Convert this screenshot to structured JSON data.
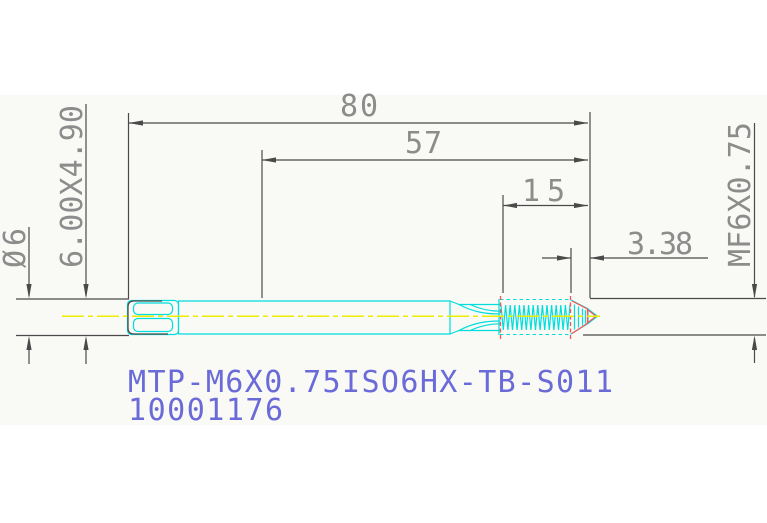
{
  "window": {
    "title": "CAD tap drawing"
  },
  "dimensions": {
    "overall_length": {
      "label": "80"
    },
    "functional_length": {
      "label": "57"
    },
    "thread_length": {
      "label": "15"
    },
    "chamfer_length": {
      "label": "3.38"
    },
    "shank_diameter": {
      "label": "Ø6"
    },
    "square_end": {
      "label": "6.00X4.90"
    },
    "thread_spec": {
      "label": "MF6X0.75"
    }
  },
  "annotations": {
    "part_designation": "MTP-M6X0.75ISO6HX-TB-S011",
    "part_number": "10001176"
  },
  "colors": {
    "cyan": "#00dede",
    "yellow": "#ededoo",
    "red": "#ff5252",
    "blue": "#6a6ad8",
    "dimline": "#4a4a4a",
    "dimtext": "#8c8c8c",
    "tint": "#f9f9f6"
  }
}
